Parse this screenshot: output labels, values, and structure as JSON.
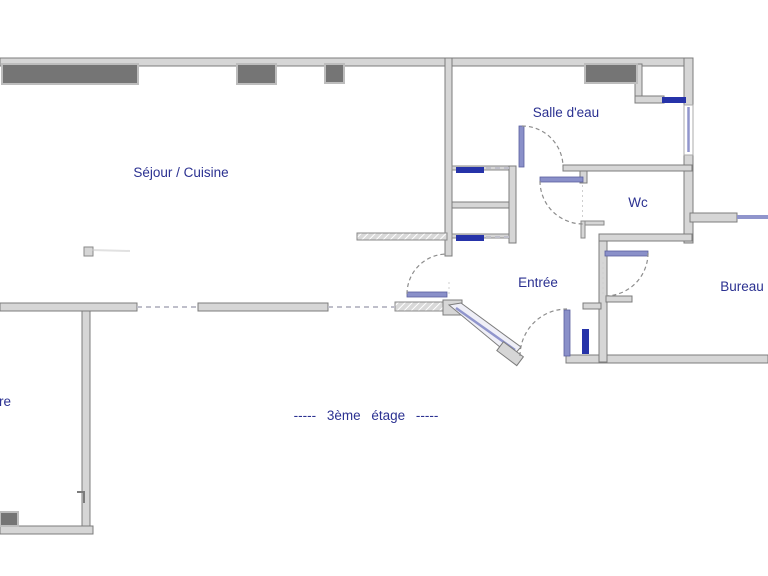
{
  "floorplan": {
    "labels": {
      "sejour": "Séjour / Cuisine",
      "salle_deau": "Salle d'eau",
      "wc": "Wc",
      "entree": "Entrée",
      "bureau": "Bureau",
      "chambre_partial": "re",
      "floor_caption": "----- 3ème étage -----"
    },
    "colors": {
      "label_text": "#2b3191",
      "wall_fill": "#d6d6d6",
      "wall_stroke": "#7c7c7c",
      "window_box_fill": "#757575",
      "window_box_frame": "#bdbdbd",
      "window_bar_navy": "#2633a9",
      "door_leaf": "#8a90c9",
      "door_arc": "#8d8d8d",
      "background": "#ffffff"
    },
    "fixtures": {
      "dark_window_boxes": 5,
      "door_swings": 5,
      "navy_window_bars": 4,
      "light_window_bars": 2
    }
  }
}
